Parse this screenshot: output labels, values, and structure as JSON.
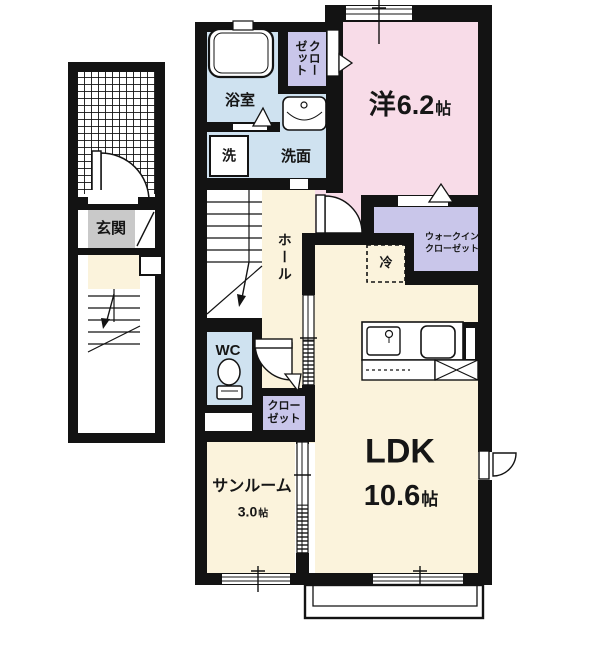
{
  "floor_plan": {
    "rooms": {
      "bedroom": {
        "label": "洋",
        "size": "6.2",
        "unit": "帖"
      },
      "ldk": {
        "label": "LDK",
        "size": "10.6",
        "unit": "帖"
      },
      "sunroom": {
        "label": "サンルーム",
        "size": "3.0",
        "unit": "帖"
      },
      "hall": {
        "label": "ホール"
      },
      "entrance": {
        "label": "玄関"
      },
      "bathroom": {
        "label": "浴室"
      },
      "washer": {
        "label": "洗"
      },
      "washroom": {
        "label": "洗面"
      },
      "wc": {
        "label": "WC"
      },
      "refrigerator": {
        "label": "冷"
      },
      "closet_upper": {
        "col_right": "クロー",
        "col_left": "ゼット"
      },
      "closet_lower": {
        "label": "クローゼット"
      },
      "walk_in_closet": {
        "label": "ウォークインクローゼット"
      }
    },
    "colors": {
      "wall": "#131313",
      "room_cream": "#fbf3dc",
      "room_pink": "#f8dce8",
      "room_purple": "#c9c6ea",
      "room_blue": "#cfe2f0",
      "entrance_gray": "#c9c9c9"
    }
  }
}
